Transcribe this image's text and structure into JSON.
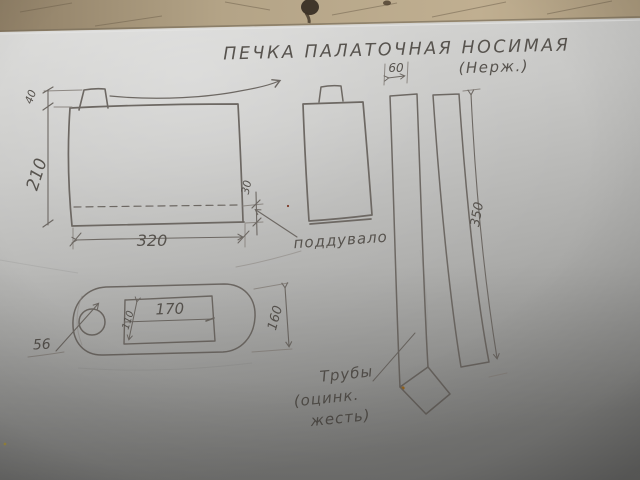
{
  "colors": {
    "pencil": "#6d6863",
    "paper_light": "#d4d4d2",
    "paper_dark": "#8b8b89",
    "table_wood": "#b3a286"
  },
  "title": {
    "main": "ПЕЧКА ПАЛАТОЧНАЯ НОСИМАЯ",
    "material_note": "(Нерж.)"
  },
  "front_view": {
    "dim_chimney_stub_height": "40",
    "dim_body_height": "210",
    "dim_body_width": "320",
    "dim_ash_pit_height": "30"
  },
  "side_view": {
    "label_ash_pit": "поддувало"
  },
  "top_view": {
    "dim_opening_length": "170",
    "dim_opening_width": "110",
    "dim_oval_width": "160",
    "dim_hole_diameter": "56"
  },
  "pipes": {
    "dim_pipe_width": "60",
    "dim_pipe_length": "350",
    "label_line1": "Трубы",
    "label_line2": "(оцинк.",
    "label_line3": "жесть)"
  }
}
